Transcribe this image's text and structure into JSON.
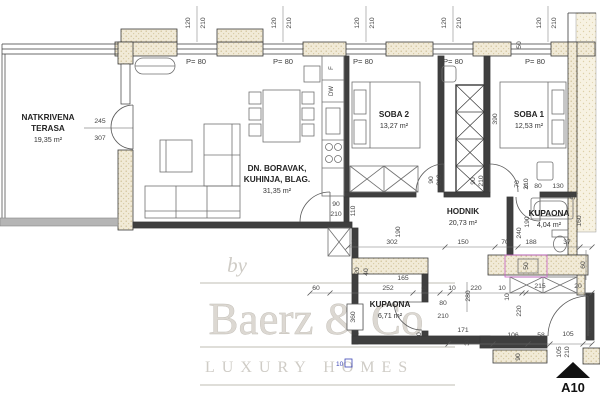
{
  "plan": {
    "rooms": [
      {
        "id": "terasa",
        "lines": [
          "NATKRIVENA",
          "TERASA"
        ],
        "area": "19,35 m²",
        "x": 48,
        "y": 120
      },
      {
        "id": "boravak",
        "lines": [
          "DN. BORAVAK,",
          "KUHINJA, BLAG."
        ],
        "area": "31,35 m²",
        "x": 277,
        "y": 171
      },
      {
        "id": "soba2",
        "lines": [
          "SOBA 2"
        ],
        "area": "13,27 m²",
        "x": 394,
        "y": 117
      },
      {
        "id": "soba1",
        "lines": [
          "SOBA 1"
        ],
        "area": "12,53 m²",
        "x": 529,
        "y": 117
      },
      {
        "id": "hodnik",
        "lines": [
          "HODNIK"
        ],
        "area": "20,73 m²",
        "x": 463,
        "y": 214
      },
      {
        "id": "kupaona",
        "lines": [
          "KUPAONA"
        ],
        "area": "4,04 m²",
        "x": 549,
        "y": 216
      },
      {
        "id": "kupaona2",
        "lines": [
          "KUPAONA"
        ],
        "area": "6,71 m²",
        "x": 390,
        "y": 307
      }
    ],
    "window_labels": [
      {
        "t": "P= 80",
        "x": 196,
        "y": 64
      },
      {
        "t": "P= 80",
        "x": 283,
        "y": 64
      },
      {
        "t": "P= 80",
        "x": 363,
        "y": 64
      },
      {
        "t": "P= 80",
        "x": 453,
        "y": 64
      },
      {
        "t": "P= 80",
        "x": 535,
        "y": 64
      }
    ],
    "top_dims": [
      {
        "cx": 197,
        "a": "120",
        "b": "210"
      },
      {
        "cx": 283,
        "a": "120",
        "b": "210"
      },
      {
        "cx": 366,
        "a": "120",
        "b": "210"
      },
      {
        "cx": 453,
        "a": "120",
        "b": "210"
      },
      {
        "cx": 548,
        "a": "120",
        "b": "210"
      }
    ],
    "dims": [
      {
        "t": "50",
        "x": 521,
        "y": 45,
        "r": 1
      },
      {
        "t": "245",
        "x": 100,
        "y": 123
      },
      {
        "t": "307",
        "x": 100,
        "y": 140
      },
      {
        "t": "90",
        "x": 336,
        "y": 206
      },
      {
        "t": "210",
        "x": 336,
        "y": 216
      },
      {
        "t": "110",
        "x": 355,
        "y": 211,
        "r": 1
      },
      {
        "t": "80",
        "x": 356,
        "y": 243,
        "r": 1
      },
      {
        "t": "190",
        "x": 400,
        "y": 232,
        "r": 1
      },
      {
        "t": "90",
        "x": 433,
        "y": 180,
        "r": 1
      },
      {
        "t": "210",
        "x": 441,
        "y": 180,
        "r": 1
      },
      {
        "t": "90",
        "x": 475,
        "y": 181,
        "r": 1
      },
      {
        "t": "210",
        "x": 483,
        "y": 181,
        "r": 1
      },
      {
        "t": "70",
        "x": 519,
        "y": 184,
        "r": 1
      },
      {
        "t": "210",
        "x": 528,
        "y": 184,
        "r": 1
      },
      {
        "t": "5",
        "x": 526,
        "y": 188
      },
      {
        "t": "80",
        "x": 538,
        "y": 188
      },
      {
        "t": "130",
        "x": 558,
        "y": 188
      },
      {
        "t": "30",
        "x": 575,
        "y": 196,
        "r": 1
      },
      {
        "t": "160",
        "x": 581,
        "y": 221,
        "r": 1
      },
      {
        "t": "190",
        "x": 529,
        "y": 222,
        "r": 1
      },
      {
        "t": "240",
        "x": 521,
        "y": 233,
        "r": 1
      },
      {
        "t": "390",
        "x": 497,
        "y": 119,
        "r": 1
      },
      {
        "t": "302",
        "x": 392,
        "y": 244
      },
      {
        "t": "150",
        "x": 463,
        "y": 244
      },
      {
        "t": "70",
        "x": 505,
        "y": 244
      },
      {
        "t": "188",
        "x": 531,
        "y": 244
      },
      {
        "t": "37",
        "x": 567,
        "y": 244
      },
      {
        "t": "60",
        "x": 585,
        "y": 265,
        "r": 1
      },
      {
        "t": "20",
        "x": 359,
        "y": 271,
        "r": 1
      },
      {
        "t": "40",
        "x": 368,
        "y": 272,
        "r": 1
      },
      {
        "t": "165",
        "x": 403,
        "y": 280
      },
      {
        "t": "60",
        "x": 316,
        "y": 290
      },
      {
        "t": "252",
        "x": 388,
        "y": 290
      },
      {
        "t": "70",
        "x": 426,
        "y": 290,
        "r": 1
      },
      {
        "t": "10",
        "x": 452,
        "y": 290
      },
      {
        "t": "220",
        "x": 476,
        "y": 290
      },
      {
        "t": "10",
        "x": 502,
        "y": 290
      },
      {
        "t": "215",
        "x": 540,
        "y": 288
      },
      {
        "t": "20",
        "x": 578,
        "y": 288
      },
      {
        "t": "10",
        "x": 509,
        "y": 297,
        "r": 1
      },
      {
        "t": "280",
        "x": 470,
        "y": 296,
        "r": 1
      },
      {
        "t": "80",
        "x": 443,
        "y": 305
      },
      {
        "t": "210",
        "x": 443,
        "y": 318
      },
      {
        "t": "50",
        "x": 528,
        "y": 266,
        "r": 1
      },
      {
        "t": "360",
        "x": 355,
        "y": 317,
        "r": 1,
        "boxed": true
      },
      {
        "t": "20",
        "x": 421,
        "y": 336,
        "r": 1
      },
      {
        "t": "220",
        "x": 521,
        "y": 311,
        "r": 1
      },
      {
        "t": "171",
        "x": 463,
        "y": 332
      },
      {
        "t": "30",
        "x": 469,
        "y": 342,
        "r": 1
      },
      {
        "t": "106",
        "x": 513,
        "y": 337
      },
      {
        "t": "58",
        "x": 541,
        "y": 337
      },
      {
        "t": "105",
        "x": 568,
        "y": 336
      },
      {
        "t": "5",
        "x": 590,
        "y": 333
      },
      {
        "t": "90",
        "x": 520,
        "y": 357,
        "r": 1
      },
      {
        "t": "105",
        "x": 561,
        "y": 352,
        "r": 1
      },
      {
        "t": "210",
        "x": 569,
        "y": 352,
        "r": 1
      }
    ],
    "appliances": [
      {
        "t": "F"
      },
      {
        "t": "DW"
      }
    ],
    "marker": "A10",
    "blue_note": "10"
  },
  "watermark": {
    "by": "by",
    "brand": "Baerz & Co",
    "tagline": "LUXURY HOMES"
  }
}
